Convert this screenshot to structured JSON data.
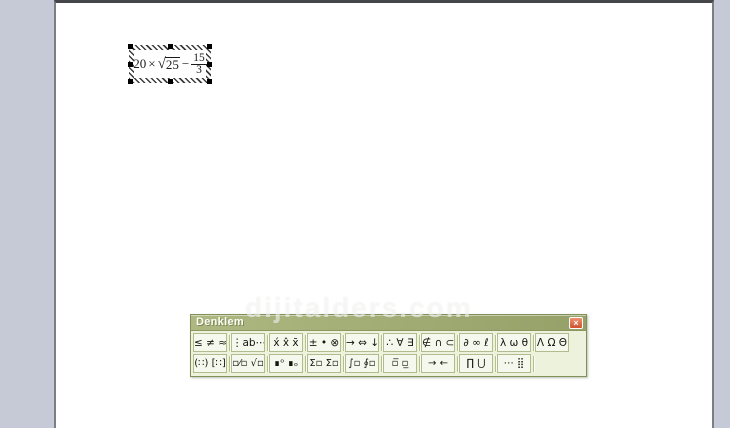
{
  "colors": {
    "workspace": "#c6cad6",
    "page": "#ffffff",
    "titlebar_left": "#aeb781",
    "titlebar_right": "#95a168",
    "toolbar_face": "#edf2dd",
    "button_face": "#f5f8ed",
    "button_border": "#b0bc8e",
    "toolbar_border": "#82915a",
    "close_red": "#dd6a4a",
    "title_text": "#fcfdf5"
  },
  "equation_object": {
    "term": "20",
    "times_sign": "×",
    "radical_sign": "√",
    "radicand": "25",
    "minus_sign": "−",
    "numerator": "15",
    "denominator": "3"
  },
  "equation_toolbar": {
    "title": "Denklem",
    "close_glyph": "×",
    "top_row": [
      {
        "name": "relational-symbols-button",
        "glyphs": "≤ ≠ ≈"
      },
      {
        "name": "spaces-ellipses-button",
        "glyphs": "⋮ab⋯"
      },
      {
        "name": "embellishments-button",
        "glyphs": "x́ x̂ x̄"
      },
      {
        "name": "operator-symbols-button",
        "glyphs": "± • ⊗"
      },
      {
        "name": "arrow-symbols-button",
        "glyphs": "→ ⇔ ↓"
      },
      {
        "name": "logical-symbols-button",
        "glyphs": "∴ ∀ ∃"
      },
      {
        "name": "set-theory-symbols-button",
        "glyphs": "∉ ∩ ⊂"
      },
      {
        "name": "misc-symbols-button",
        "glyphs": "∂ ∞ ℓ"
      },
      {
        "name": "greek-lowercase-button",
        "glyphs": "λ ω θ"
      },
      {
        "name": "greek-uppercase-button",
        "glyphs": "Λ Ω Θ"
      }
    ],
    "bottom_row": [
      {
        "name": "fence-templates-button",
        "glyphs": "(∷) [∷]"
      },
      {
        "name": "fraction-radical-templates-button",
        "glyphs": "▫⁄▫ √▫"
      },
      {
        "name": "subscript-superscript-templates-button",
        "glyphs": "∎ᵒ ∎ₒ"
      },
      {
        "name": "summation-templates-button",
        "glyphs": "Σ▫ Σ▫"
      },
      {
        "name": "integral-templates-button",
        "glyphs": "∫▫ ∮▫"
      },
      {
        "name": "overbar-underbar-templates-button",
        "glyphs": "▫̅ ▫̲"
      },
      {
        "name": "labeled-arrow-templates-button",
        "glyphs": "→ ←"
      },
      {
        "name": "product-set-templates-button",
        "glyphs": "∏ ⋃"
      },
      {
        "name": "matrix-templates-button",
        "glyphs": "⋯ ⣿"
      }
    ]
  },
  "watermark": {
    "text": "dijitalders.com"
  }
}
